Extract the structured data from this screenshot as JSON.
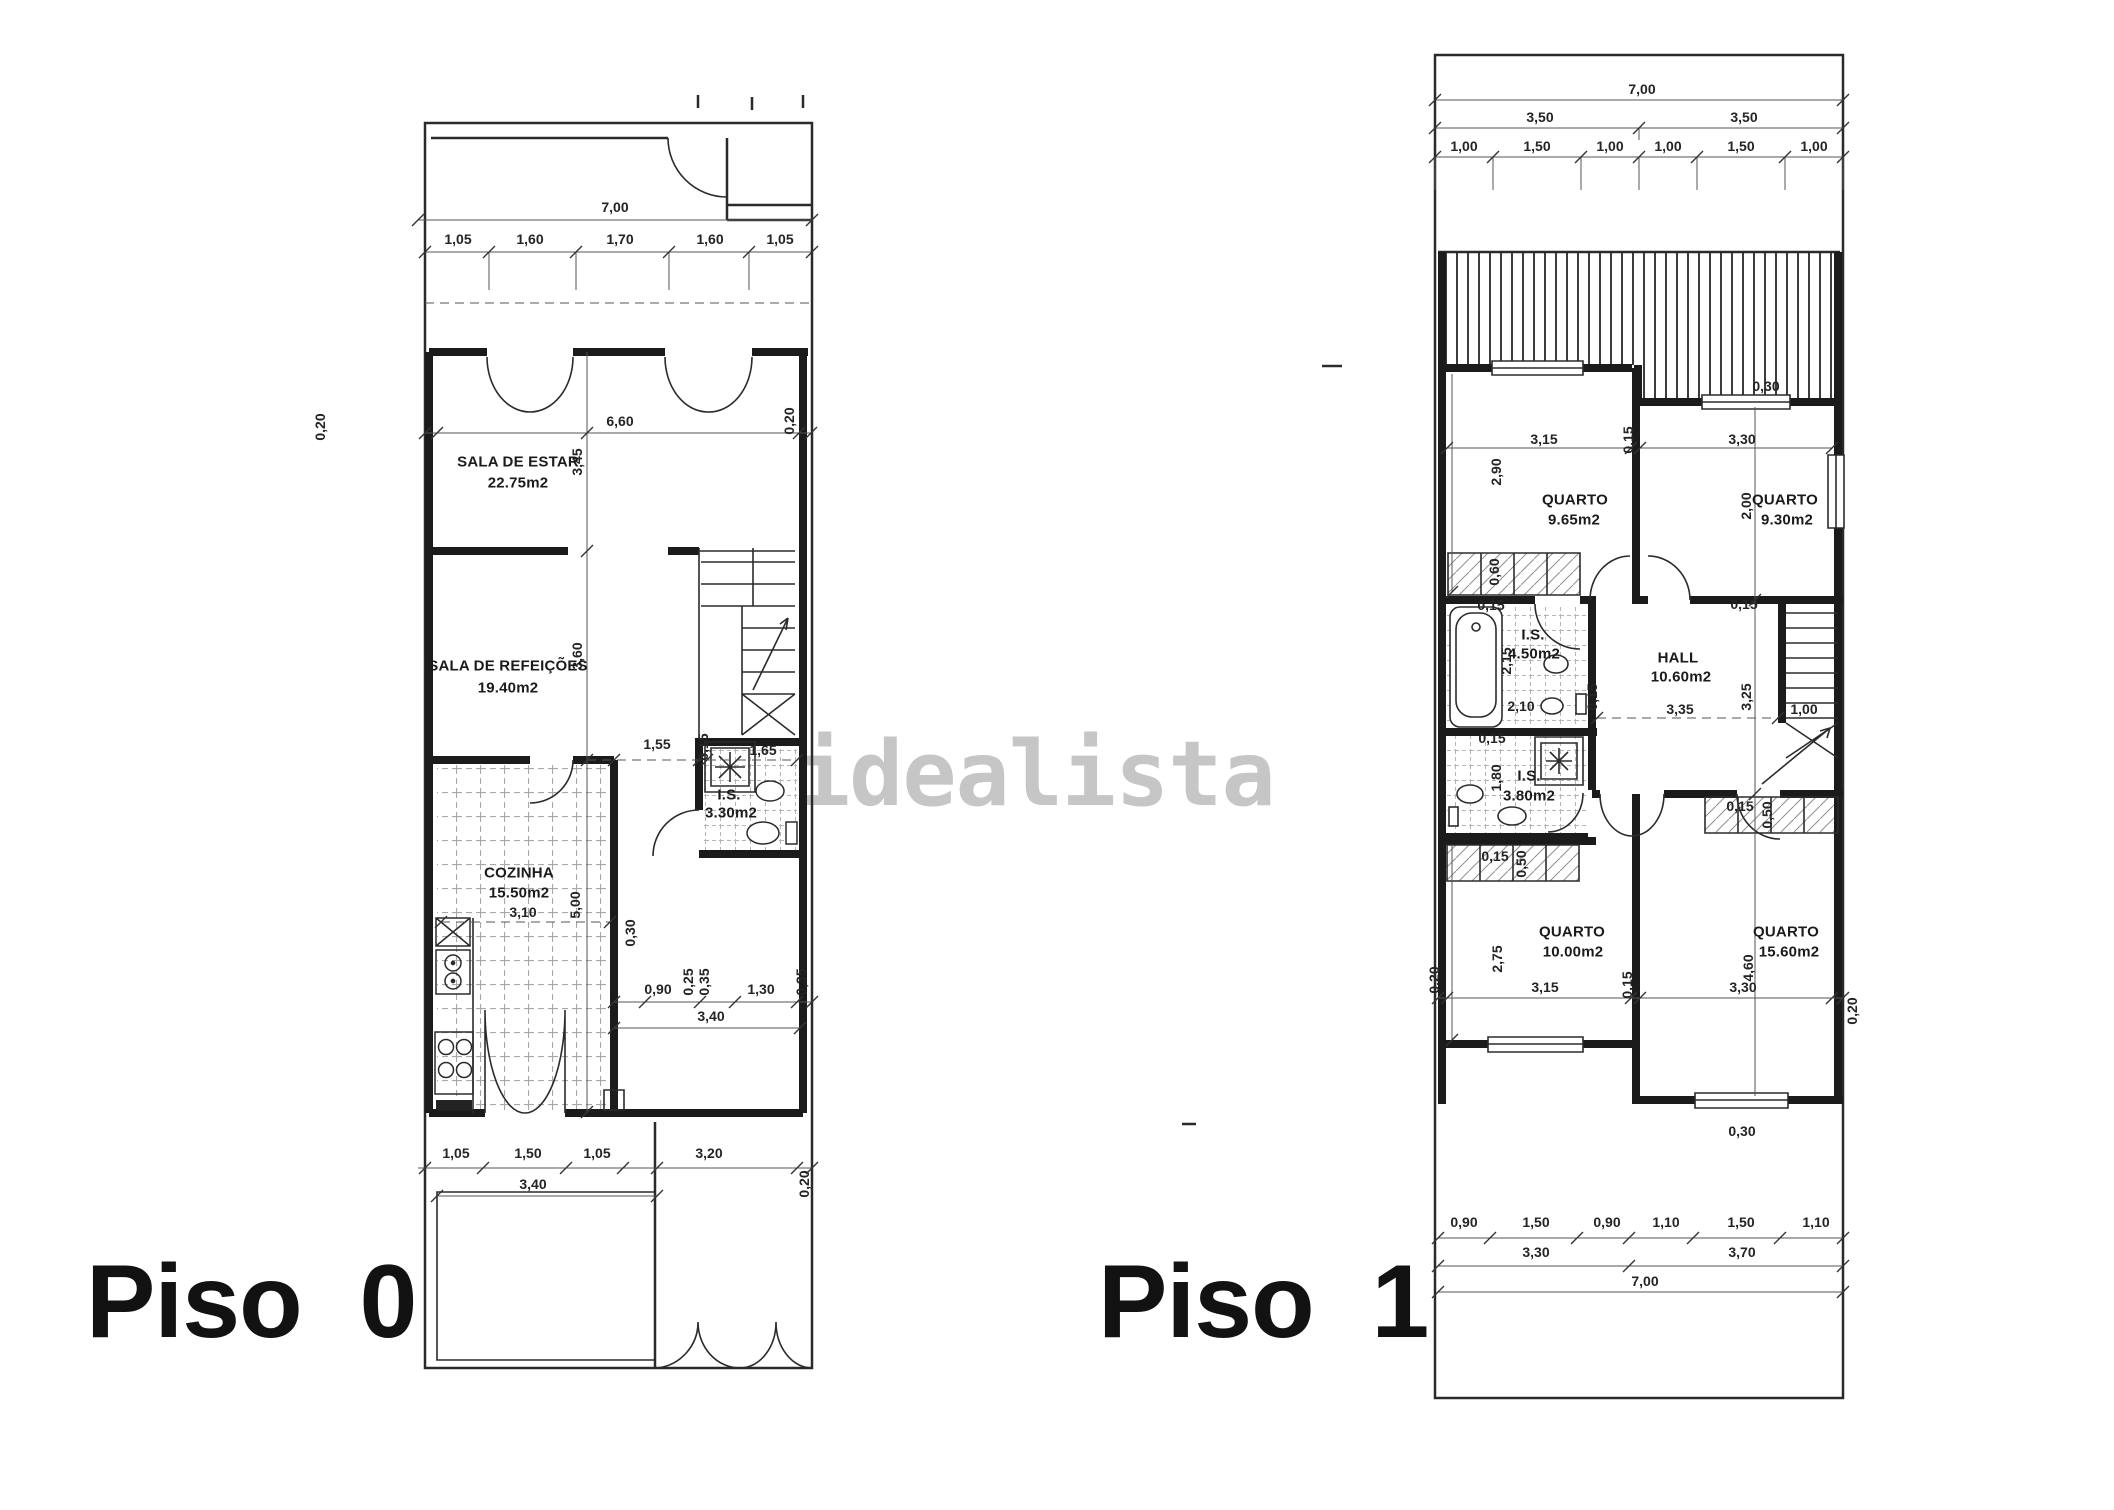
{
  "watermark": "idealista",
  "piso0": {
    "title": "Piso 0",
    "rooms": [
      {
        "name": "SALA DE ESTAR",
        "area": "22.75m2"
      },
      {
        "name": "SALA DE REFEIÇÕES",
        "area": "19.40m2"
      },
      {
        "name": "COZINHA",
        "area": "15.50m2"
      },
      {
        "name": "I.S.",
        "area": "3.30m2"
      }
    ],
    "dims": [
      "7,00",
      "1,05",
      "1,60",
      "1,70",
      "1,60",
      "1,05",
      "0,20",
      "6,60",
      "0,20",
      "3,45",
      "3,60",
      "1,55",
      "0,15",
      "1,65",
      "0,30",
      "3,10",
      "5,00",
      "0,90",
      "0,25",
      "0,35",
      "1,30",
      "0,35",
      "3,40",
      "1,05",
      "1,50",
      "1,05",
      "3,20",
      "3,40",
      "0,20"
    ]
  },
  "piso1": {
    "title": "Piso 1",
    "rooms": [
      {
        "name": "QUARTO",
        "area": "9.65m2"
      },
      {
        "name": "QUARTO",
        "area": "9.30m2"
      },
      {
        "name": "I.S.",
        "area": "4.50m2"
      },
      {
        "name": "HALL",
        "area": "10.60m2"
      },
      {
        "name": "I.S.",
        "area": "3.80m2"
      },
      {
        "name": "QUARTO",
        "area": "10.00m2"
      },
      {
        "name": "QUARTO",
        "area": "15.60m2"
      }
    ],
    "dims": [
      "7,00",
      "3,50",
      "3,50",
      "1,00",
      "1,50",
      "1,00",
      "1,00",
      "1,50",
      "1,00",
      "0,30",
      "3,15",
      "0,15",
      "3,30",
      "2,90",
      "2,00",
      "0,60",
      "0,15",
      "2,15",
      "2,10",
      "0,15",
      "0,15",
      "3,35",
      "3,25",
      "1,00",
      "0,15",
      "1,80",
      "0,15",
      "0,50",
      "0,15",
      "0,50",
      "2,75",
      "3,15",
      "0,15",
      "4,60",
      "3,30",
      "0,20",
      "0,20",
      "0,30",
      "0,90",
      "1,50",
      "0,90",
      "1,10",
      "1,50",
      "1,10",
      "3,30",
      "3,70",
      "7,00"
    ]
  }
}
